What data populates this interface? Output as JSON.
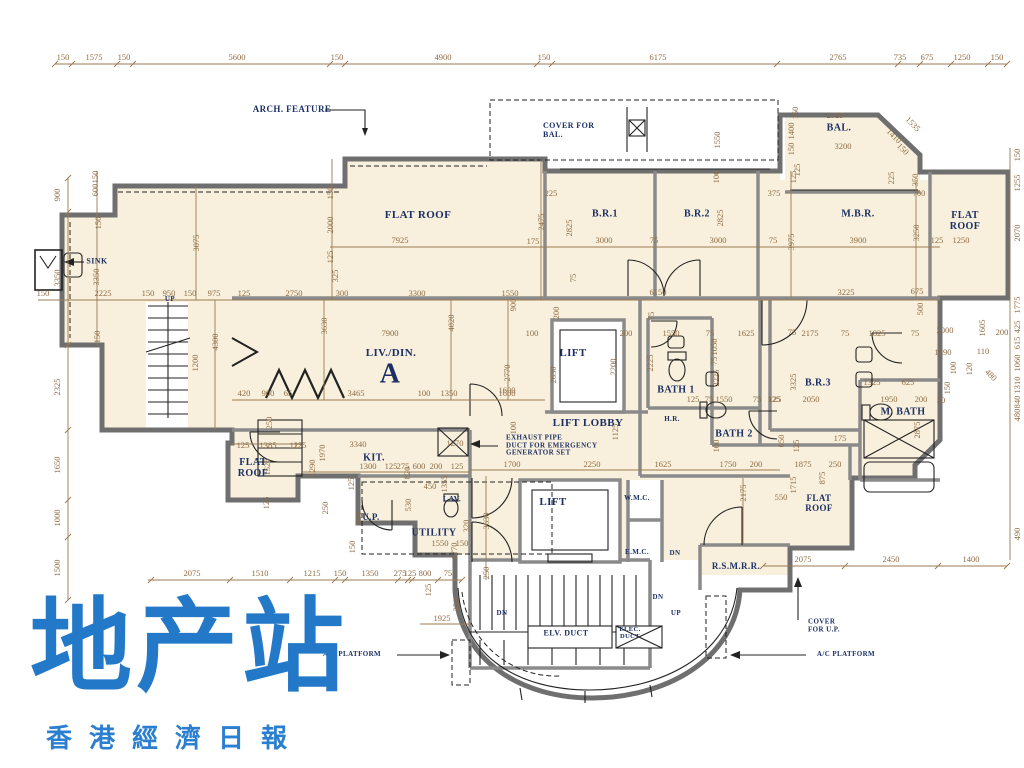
{
  "watermark": {
    "title": "地产站",
    "subtitle": "香港經濟日報",
    "color": "#2478c8"
  },
  "plan": {
    "room_fill": "#f8f0dc",
    "dim_color": "#9b7a52",
    "label_color": "#1c2f66",
    "dims": [
      [
        "150",
        63,
        57
      ],
      [
        "1575",
        94,
        57
      ],
      [
        "150",
        124,
        57
      ],
      [
        "5600",
        237,
        57
      ],
      [
        "150",
        337,
        57
      ],
      [
        "4900",
        443,
        57
      ],
      [
        "150",
        544,
        57
      ],
      [
        "6175",
        658,
        57
      ],
      [
        "2765",
        838,
        57
      ],
      [
        "735",
        900,
        57
      ],
      [
        "675",
        927,
        57
      ],
      [
        "1250",
        962,
        57
      ],
      [
        "150",
        997,
        57
      ],
      [
        "900",
        57,
        195,
        "r"
      ],
      [
        "3350",
        57,
        278,
        "r"
      ],
      [
        "2325",
        57,
        387,
        "r"
      ],
      [
        "1650",
        57,
        465,
        "r"
      ],
      [
        "1000",
        57,
        518,
        "r"
      ],
      [
        "1500",
        57,
        568,
        "r"
      ],
      [
        "150",
        1017,
        155,
        "r"
      ],
      [
        "1255",
        1017,
        183,
        "r"
      ],
      [
        "2070",
        1017,
        233,
        "r"
      ],
      [
        "1775",
        1017,
        305,
        "r"
      ],
      [
        "425",
        1017,
        327,
        "r"
      ],
      [
        "615",
        1017,
        343,
        "r"
      ],
      [
        "1060",
        1017,
        363,
        "r"
      ],
      [
        "1310",
        1017,
        385,
        "r"
      ],
      [
        "840",
        1017,
        402,
        "r"
      ],
      [
        "480",
        1017,
        415,
        "r"
      ],
      [
        "490",
        1017,
        534,
        "r"
      ],
      [
        "2075",
        192,
        573
      ],
      [
        "1510",
        260,
        573
      ],
      [
        "1215",
        312,
        573
      ],
      [
        "150",
        340,
        573
      ],
      [
        "1350",
        370,
        573
      ],
      [
        "275",
        400,
        573
      ],
      [
        "125",
        410,
        573
      ],
      [
        "800",
        425,
        573
      ],
      [
        "750",
        450,
        573
      ],
      [
        "2075",
        803,
        559
      ],
      [
        "2450",
        891,
        559
      ],
      [
        "1400",
        971,
        559
      ],
      [
        "150",
        43,
        293
      ],
      [
        "2225",
        103,
        293
      ],
      [
        "150",
        148,
        293
      ],
      [
        "950",
        169,
        293
      ],
      [
        "150",
        190,
        293
      ],
      [
        "975",
        214,
        293
      ],
      [
        "125",
        244,
        293
      ],
      [
        "2750",
        294,
        293
      ],
      [
        "300",
        342,
        293
      ],
      [
        "3300",
        417,
        293
      ],
      [
        "1550",
        510,
        293
      ],
      [
        "6150",
        658,
        292
      ],
      [
        "3225",
        846,
        292
      ],
      [
        "675",
        917,
        291
      ],
      [
        "125",
        937,
        240
      ],
      [
        "1250",
        961,
        240
      ],
      [
        "3075",
        196,
        243,
        "r"
      ],
      [
        "600",
        95,
        190,
        "r"
      ],
      [
        "150",
        95,
        177,
        "r"
      ],
      [
        "150",
        98,
        223,
        "r"
      ],
      [
        "3350",
        96,
        277,
        "r"
      ],
      [
        "150",
        97,
        337,
        "r"
      ],
      [
        "150",
        330,
        193,
        "r"
      ],
      [
        "2000",
        330,
        225,
        "r"
      ],
      [
        "125",
        330,
        257,
        "r"
      ],
      [
        "325",
        335,
        276,
        "r"
      ],
      [
        "4300",
        215,
        342,
        "r"
      ],
      [
        "1200",
        195,
        363,
        "r"
      ],
      [
        "3630",
        324,
        326,
        "r"
      ],
      [
        "2475",
        541,
        222,
        "r"
      ],
      [
        "7925",
        400,
        240
      ],
      [
        "175",
        533,
        241
      ],
      [
        "420",
        244,
        393
      ],
      [
        "900",
        268,
        393
      ],
      [
        "65",
        288,
        393
      ],
      [
        "3465",
        356,
        393
      ],
      [
        "100",
        424,
        393
      ],
      [
        "1350",
        449,
        393
      ],
      [
        "1600",
        507,
        393
      ],
      [
        "7900",
        390,
        333
      ],
      [
        "4020",
        451,
        323,
        "r"
      ],
      [
        "900",
        513,
        305,
        "r"
      ],
      [
        "2770",
        507,
        373,
        "r"
      ],
      [
        "2630",
        553,
        375,
        "r"
      ],
      [
        "2200",
        613,
        367,
        "r"
      ],
      [
        "125",
        300,
        445
      ],
      [
        "3340",
        358,
        444
      ],
      [
        "1970",
        322,
        453,
        "r"
      ],
      [
        "1290",
        312,
        468,
        "r"
      ],
      [
        "1300",
        368,
        466
      ],
      [
        "125",
        391,
        466
      ],
      [
        "275",
        403,
        466
      ],
      [
        "600",
        419,
        466
      ],
      [
        "200",
        436,
        466
      ],
      [
        "125",
        457,
        466
      ],
      [
        "820",
        407,
        473,
        "r"
      ],
      [
        "1270",
        455,
        443
      ],
      [
        "450",
        430,
        486
      ],
      [
        "1355",
        444,
        484,
        "r"
      ],
      [
        "530",
        408,
        505,
        "r"
      ],
      [
        "850",
        358,
        518,
        "r"
      ],
      [
        "250",
        325,
        508,
        "r"
      ],
      [
        "125",
        351,
        484,
        "r"
      ],
      [
        "150",
        352,
        547,
        "r"
      ],
      [
        "125",
        243,
        445
      ],
      [
        "1385",
        268,
        445
      ],
      [
        "125",
        296,
        445
      ],
      [
        "1525",
        267,
        467,
        "r"
      ],
      [
        "125",
        266,
        503,
        "r"
      ],
      [
        "250",
        269,
        423,
        "r"
      ],
      [
        "1550",
        440,
        543
      ],
      [
        "150",
        462,
        543
      ],
      [
        "1770",
        454,
        551,
        "r"
      ],
      [
        "320",
        466,
        526,
        "r"
      ],
      [
        "3630",
        486,
        521,
        "r"
      ],
      [
        "1700",
        512,
        464
      ],
      [
        "2250",
        592,
        464
      ],
      [
        "1625",
        663,
        464
      ],
      [
        "1750",
        728,
        464
      ],
      [
        "200",
        756,
        464
      ],
      [
        "200",
        556,
        313,
        "r"
      ],
      [
        "100",
        532,
        333
      ],
      [
        "200",
        626,
        333
      ],
      [
        "75",
        651,
        316,
        "r"
      ],
      [
        "1550",
        671,
        333
      ],
      [
        "75",
        710,
        333
      ],
      [
        "1625",
        746,
        333
      ],
      [
        "1050",
        714,
        347,
        "r"
      ],
      [
        "75",
        714,
        361,
        "r"
      ],
      [
        "2225",
        650,
        363,
        "r"
      ],
      [
        "2225",
        716,
        378,
        "r"
      ],
      [
        "1600",
        507,
        390
      ],
      [
        "125",
        693,
        399
      ],
      [
        "75",
        709,
        399
      ],
      [
        "1550",
        724,
        399
      ],
      [
        "75",
        757,
        399
      ],
      [
        "125",
        774,
        399
      ],
      [
        "1125",
        615,
        432,
        "r"
      ],
      [
        "100",
        513,
        428,
        "r"
      ],
      [
        "100",
        716,
        446,
        "r"
      ],
      [
        "225",
        551,
        193
      ],
      [
        "2825",
        569,
        228,
        "r"
      ],
      [
        "3000",
        604,
        240
      ],
      [
        "75",
        654,
        240
      ],
      [
        "2825",
        720,
        218,
        "r"
      ],
      [
        "3000",
        718,
        240
      ],
      [
        "75",
        773,
        240
      ],
      [
        "375",
        774,
        193
      ],
      [
        "3975",
        791,
        242,
        "r"
      ],
      [
        "75",
        573,
        278,
        "r"
      ],
      [
        "100",
        716,
        177,
        "r"
      ],
      [
        "125",
        797,
        170,
        "r"
      ],
      [
        "3900",
        858,
        240
      ],
      [
        "3250",
        916,
        233,
        "r"
      ],
      [
        "700",
        919,
        193
      ],
      [
        "225",
        891,
        178,
        "r"
      ],
      [
        "350",
        915,
        180,
        "r"
      ],
      [
        "125",
        793,
        177,
        "r"
      ],
      [
        "2000",
        945,
        330
      ],
      [
        "1605",
        982,
        328,
        "r"
      ],
      [
        "200",
        1002,
        332
      ],
      [
        "1890",
        943,
        352
      ],
      [
        "110",
        983,
        351
      ],
      [
        "100",
        953,
        368,
        "r"
      ],
      [
        "120",
        969,
        369,
        "r"
      ],
      [
        "480",
        991,
        375,
        "d"
      ],
      [
        "150",
        947,
        388,
        "r"
      ],
      [
        "50",
        941,
        400
      ],
      [
        "500",
        920,
        309,
        "r"
      ],
      [
        "2525",
        835,
        115
      ],
      [
        "3200",
        843,
        146
      ],
      [
        "150",
        795,
        113,
        "r"
      ],
      [
        "1400",
        791,
        131,
        "r"
      ],
      [
        "150",
        791,
        149,
        "r"
      ],
      [
        "1535",
        913,
        124,
        "d"
      ],
      [
        "1410",
        894,
        136,
        "d"
      ],
      [
        "150",
        903,
        149,
        "d"
      ],
      [
        "1550",
        717,
        140,
        "r"
      ],
      [
        "75",
        792,
        332
      ],
      [
        "2175",
        810,
        333
      ],
      [
        "75",
        845,
        333
      ],
      [
        "1825",
        877,
        333
      ],
      [
        "75",
        915,
        333
      ],
      [
        "3325",
        793,
        382,
        "r"
      ],
      [
        "1325",
        872,
        382
      ],
      [
        "625",
        908,
        382
      ],
      [
        "2050",
        811,
        399
      ],
      [
        "1950",
        889,
        399
      ],
      [
        "200",
        921,
        399
      ],
      [
        "125",
        775,
        399
      ],
      [
        "2875",
        917,
        430,
        "r"
      ],
      [
        "650",
        781,
        441,
        "r"
      ],
      [
        "125",
        796,
        446,
        "r"
      ],
      [
        "175",
        840,
        438
      ],
      [
        "1875",
        803,
        464
      ],
      [
        "250",
        835,
        464
      ],
      [
        "875",
        822,
        478,
        "r"
      ],
      [
        "1715",
        793,
        485,
        "r"
      ],
      [
        "550",
        781,
        497
      ],
      [
        "2175",
        743,
        493,
        "r"
      ],
      [
        "250",
        486,
        573,
        "r"
      ],
      [
        "1925",
        442,
        618
      ],
      [
        "250",
        456,
        605,
        "r"
      ],
      [
        "125",
        428,
        590,
        "r"
      ]
    ],
    "labels": [
      {
        "id": "arch-feature",
        "t": "ARCH. FEATURE",
        "x": 292,
        "y": 110,
        "fs": 9
      },
      {
        "id": "cover-for-bal",
        "t": "COVER FOR\nBAL.",
        "x": 543,
        "y": 131,
        "fs": 8,
        "align": "left"
      },
      {
        "id": "sink",
        "t": "SINK",
        "x": 97,
        "y": 262,
        "fs": 8
      },
      {
        "id": "flat-roof-main",
        "t": "FLAT ROOF",
        "x": 418,
        "y": 215,
        "fs": 11
      },
      {
        "id": "br1",
        "t": "B.R.1",
        "x": 605,
        "y": 214,
        "fs": 10
      },
      {
        "id": "br2",
        "t": "B.R.2",
        "x": 697,
        "y": 214,
        "fs": 10
      },
      {
        "id": "mbr",
        "t": "M.B.R.",
        "x": 858,
        "y": 214,
        "fs": 10
      },
      {
        "id": "bal",
        "t": "BAL.",
        "x": 839,
        "y": 128,
        "fs": 10
      },
      {
        "id": "flat-roof-right",
        "t": "FLAT\nROOF",
        "x": 965,
        "y": 221,
        "fs": 10
      },
      {
        "id": "liv-din",
        "t": "LIV./DIN.",
        "x": 391,
        "y": 353,
        "fs": 11
      },
      {
        "id": "unit-a",
        "t": "A",
        "x": 390,
        "y": 375,
        "fs": 28
      },
      {
        "id": "lift-upper",
        "t": "LIFT",
        "x": 573,
        "y": 353,
        "fs": 11
      },
      {
        "id": "bath1",
        "t": "BATH 1",
        "x": 676,
        "y": 390,
        "fs": 10
      },
      {
        "id": "lift-lobby",
        "t": "LIFT LOBBY",
        "x": 588,
        "y": 423,
        "fs": 11
      },
      {
        "id": "hr",
        "t": "H.R.",
        "x": 672,
        "y": 420,
        "fs": 7
      },
      {
        "id": "bath2",
        "t": "BATH 2",
        "x": 734,
        "y": 434,
        "fs": 10
      },
      {
        "id": "br3",
        "t": "B.R.3",
        "x": 818,
        "y": 383,
        "fs": 10
      },
      {
        "id": "m-bath",
        "t": "M. BATH",
        "x": 903,
        "y": 412,
        "fs": 10
      },
      {
        "id": "exhaust-pipe",
        "t": "EXHAUST PIPE\nDUCT FOR EMERGENCY\nGENERATOR SET",
        "x": 506,
        "y": 446,
        "fs": 7,
        "align": "left"
      },
      {
        "id": "kit",
        "t": "KIT.",
        "x": 374,
        "y": 458,
        "fs": 10
      },
      {
        "id": "flat-roof-left",
        "t": "FLAT\nROOF",
        "x": 253,
        "y": 468,
        "fs": 10
      },
      {
        "id": "up-area",
        "t": "U.P.",
        "x": 371,
        "y": 518,
        "fs": 9
      },
      {
        "id": "utility",
        "t": "UTILITY",
        "x": 434,
        "y": 533,
        "fs": 10
      },
      {
        "id": "lav",
        "t": "LAV.",
        "x": 452,
        "y": 500,
        "fs": 8
      },
      {
        "id": "lift-lower",
        "t": "LIFT",
        "x": 553,
        "y": 502,
        "fs": 11
      },
      {
        "id": "wmc",
        "t": "W.M.C.",
        "x": 637,
        "y": 499,
        "fs": 7
      },
      {
        "id": "emc",
        "t": "E.M.C.",
        "x": 637,
        "y": 553,
        "fs": 7
      },
      {
        "id": "rsmrr",
        "t": "R.S.M.R.R.",
        "x": 736,
        "y": 567,
        "fs": 9
      },
      {
        "id": "flat-roof-bottom-right",
        "t": "FLAT\nROOF",
        "x": 819,
        "y": 504,
        "fs": 9
      },
      {
        "id": "elv-duct",
        "t": "ELV. DUCT",
        "x": 566,
        "y": 634,
        "fs": 8
      },
      {
        "id": "elec-duct",
        "t": "ELEC.\nDUCT",
        "x": 630,
        "y": 633,
        "fs": 6.5
      },
      {
        "id": "ac-platform-left",
        "t": "A/C PLATFORM",
        "x": 352,
        "y": 655,
        "fs": 7
      },
      {
        "id": "ac-platform-right",
        "t": "A/C PLATFORM",
        "x": 846,
        "y": 655,
        "fs": 7
      },
      {
        "id": "cover-for-up",
        "t": "COVER\nFOR U.P.",
        "x": 808,
        "y": 626,
        "fs": 7,
        "align": "left"
      },
      {
        "id": "up-stair-top",
        "t": "UP",
        "x": 170,
        "y": 300,
        "fs": 7
      },
      {
        "id": "dn-1",
        "t": "DN",
        "x": 675,
        "y": 554,
        "fs": 7
      },
      {
        "id": "dn-2",
        "t": "DN",
        "x": 658,
        "y": 598,
        "fs": 7
      },
      {
        "id": "dn-3",
        "t": "DN",
        "x": 502,
        "y": 614,
        "fs": 7
      },
      {
        "id": "up-stair-bottom",
        "t": "UP",
        "x": 676,
        "y": 614,
        "fs": 7
      }
    ]
  }
}
